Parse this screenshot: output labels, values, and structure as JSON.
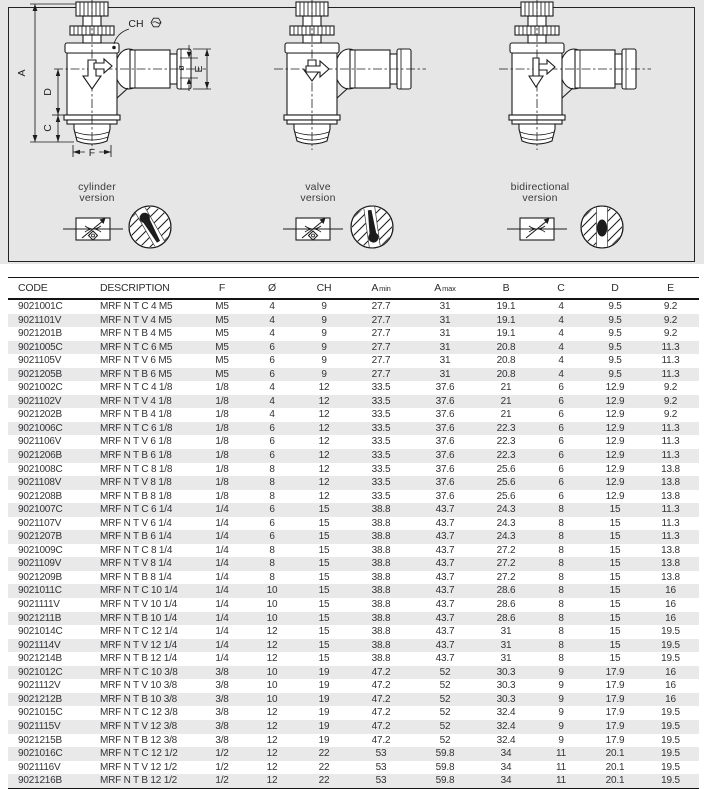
{
  "panel": {
    "versions": [
      {
        "label_line1": "cylinder",
        "label_line2": "version"
      },
      {
        "label_line1": "valve",
        "label_line2": "version"
      },
      {
        "label_line1": "bidirectional",
        "label_line2": "version"
      }
    ],
    "dimension_labels": {
      "A": "A",
      "D": "D",
      "C": "C",
      "F": "F",
      "CH": "CH",
      "diameter": "ø",
      "E": "E"
    }
  },
  "table": {
    "columns": [
      "CODE",
      "DESCRIPTION",
      "F",
      "Ø",
      "CH",
      "A min",
      "A max",
      "B",
      "C",
      "D",
      "E"
    ],
    "rows": [
      [
        "9021001C",
        "MRF N T C 4 M5",
        "M5",
        "4",
        "9",
        "27.7",
        "31",
        "19.1",
        "4",
        "9.5",
        "9.2"
      ],
      [
        "9021101V",
        "MRF N T V 4 M5",
        "M5",
        "4",
        "9",
        "27.7",
        "31",
        "19.1",
        "4",
        "9.5",
        "9.2"
      ],
      [
        "9021201B",
        "MRF N T B 4 M5",
        "M5",
        "4",
        "9",
        "27.7",
        "31",
        "19.1",
        "4",
        "9.5",
        "9.2"
      ],
      [
        "9021005C",
        "MRF N T C 6 M5",
        "M5",
        "6",
        "9",
        "27.7",
        "31",
        "20.8",
        "4",
        "9.5",
        "11.3"
      ],
      [
        "9021105V",
        "MRF N T V 6 M5",
        "M5",
        "6",
        "9",
        "27.7",
        "31",
        "20.8",
        "4",
        "9.5",
        "11.3"
      ],
      [
        "9021205B",
        "MRF N T B 6 M5",
        "M5",
        "6",
        "9",
        "27.7",
        "31",
        "20.8",
        "4",
        "9.5",
        "11.3"
      ],
      [
        "9021002C",
        "MRF N T C 4 1/8",
        "1/8",
        "4",
        "12",
        "33.5",
        "37.6",
        "21",
        "6",
        "12.9",
        "9.2"
      ],
      [
        "9021102V",
        "MRF N T V 4 1/8",
        "1/8",
        "4",
        "12",
        "33.5",
        "37.6",
        "21",
        "6",
        "12.9",
        "9.2"
      ],
      [
        "9021202B",
        "MRF N T B 4 1/8",
        "1/8",
        "4",
        "12",
        "33.5",
        "37.6",
        "21",
        "6",
        "12.9",
        "9.2"
      ],
      [
        "9021006C",
        "MRF N T C 6 1/8",
        "1/8",
        "6",
        "12",
        "33.5",
        "37.6",
        "22.3",
        "6",
        "12.9",
        "11.3"
      ],
      [
        "9021106V",
        "MRF N T V 6 1/8",
        "1/8",
        "6",
        "12",
        "33.5",
        "37.6",
        "22.3",
        "6",
        "12.9",
        "11.3"
      ],
      [
        "9021206B",
        "MRF N T B 6 1/8",
        "1/8",
        "6",
        "12",
        "33.5",
        "37.6",
        "22.3",
        "6",
        "12.9",
        "11.3"
      ],
      [
        "9021008C",
        "MRF N T C 8 1/8",
        "1/8",
        "8",
        "12",
        "33.5",
        "37.6",
        "25.6",
        "6",
        "12.9",
        "13.8"
      ],
      [
        "9021108V",
        "MRF N T V 8 1/8",
        "1/8",
        "8",
        "12",
        "33.5",
        "37.6",
        "25.6",
        "6",
        "12.9",
        "13.8"
      ],
      [
        "9021208B",
        "MRF N T B 8 1/8",
        "1/8",
        "8",
        "12",
        "33.5",
        "37.6",
        "25.6",
        "6",
        "12.9",
        "13.8"
      ],
      [
        "9021007C",
        "MRF N T C 6 1/4",
        "1/4",
        "6",
        "15",
        "38.8",
        "43.7",
        "24.3",
        "8",
        "15",
        "11.3"
      ],
      [
        "9021107V",
        "MRF N T V 6 1/4",
        "1/4",
        "6",
        "15",
        "38.8",
        "43.7",
        "24.3",
        "8",
        "15",
        "11.3"
      ],
      [
        "9021207B",
        "MRF N T B 6 1/4",
        "1/4",
        "6",
        "15",
        "38.8",
        "43.7",
        "24.3",
        "8",
        "15",
        "11.3"
      ],
      [
        "9021009C",
        "MRF N T C 8 1/4",
        "1/4",
        "8",
        "15",
        "38.8",
        "43.7",
        "27.2",
        "8",
        "15",
        "13.8"
      ],
      [
        "9021109V",
        "MRF N T V 8 1/4",
        "1/4",
        "8",
        "15",
        "38.8",
        "43.7",
        "27.2",
        "8",
        "15",
        "13.8"
      ],
      [
        "9021209B",
        "MRF N T B 8 1/4",
        "1/4",
        "8",
        "15",
        "38.8",
        "43.7",
        "27.2",
        "8",
        "15",
        "13.8"
      ],
      [
        "9021011C",
        "MRF N T C 10 1/4",
        "1/4",
        "10",
        "15",
        "38.8",
        "43.7",
        "28.6",
        "8",
        "15",
        "16"
      ],
      [
        "9021111V",
        "MRF N T V 10 1/4",
        "1/4",
        "10",
        "15",
        "38.8",
        "43.7",
        "28.6",
        "8",
        "15",
        "16"
      ],
      [
        "9021211B",
        "MRF N T B 10 1/4",
        "1/4",
        "10",
        "15",
        "38.8",
        "43.7",
        "28.6",
        "8",
        "15",
        "16"
      ],
      [
        "9021014C",
        "MRF N T C 12 1/4",
        "1/4",
        "12",
        "15",
        "38.8",
        "43.7",
        "31",
        "8",
        "15",
        "19.5"
      ],
      [
        "9021114V",
        "MRF N T V 12 1/4",
        "1/4",
        "12",
        "15",
        "38.8",
        "43.7",
        "31",
        "8",
        "15",
        "19.5"
      ],
      [
        "9021214B",
        "MRF N T B 12 1/4",
        "1/4",
        "12",
        "15",
        "38.8",
        "43.7",
        "31",
        "8",
        "15",
        "19.5"
      ],
      [
        "9021012C",
        "MRF N T C 10 3/8",
        "3/8",
        "10",
        "19",
        "47.2",
        "52",
        "30.3",
        "9",
        "17.9",
        "16"
      ],
      [
        "9021112V",
        "MRF N T V 10 3/8",
        "3/8",
        "10",
        "19",
        "47.2",
        "52",
        "30.3",
        "9",
        "17.9",
        "16"
      ],
      [
        "9021212B",
        "MRF N T B 10 3/8",
        "3/8",
        "10",
        "19",
        "47.2",
        "52",
        "30.3",
        "9",
        "17.9",
        "16"
      ],
      [
        "9021015C",
        "MRF N T C 12 3/8",
        "3/8",
        "12",
        "19",
        "47.2",
        "52",
        "32.4",
        "9",
        "17.9",
        "19.5"
      ],
      [
        "9021115V",
        "MRF N T V 12 3/8",
        "3/8",
        "12",
        "19",
        "47.2",
        "52",
        "32.4",
        "9",
        "17.9",
        "19.5"
      ],
      [
        "9021215B",
        "MRF N T B 12 3/8",
        "3/8",
        "12",
        "19",
        "47.2",
        "52",
        "32.4",
        "9",
        "17.9",
        "19.5"
      ],
      [
        "9021016C",
        "MRF N T C 12 1/2",
        "1/2",
        "12",
        "22",
        "53",
        "59.8",
        "34",
        "11",
        "20.1",
        "19.5"
      ],
      [
        "9021116V",
        "MRF N T V 12 1/2",
        "1/2",
        "12",
        "22",
        "53",
        "59.8",
        "34",
        "11",
        "20.1",
        "19.5"
      ],
      [
        "9021216B",
        "MRF N T B 12 1/2",
        "1/2",
        "12",
        "22",
        "53",
        "59.8",
        "34",
        "11",
        "20.1",
        "19.5"
      ]
    ]
  },
  "colors": {
    "panel_bg": "#e6e6e7",
    "row_alt": "#e9e9ea",
    "line": "#141414",
    "text": "#333336"
  }
}
